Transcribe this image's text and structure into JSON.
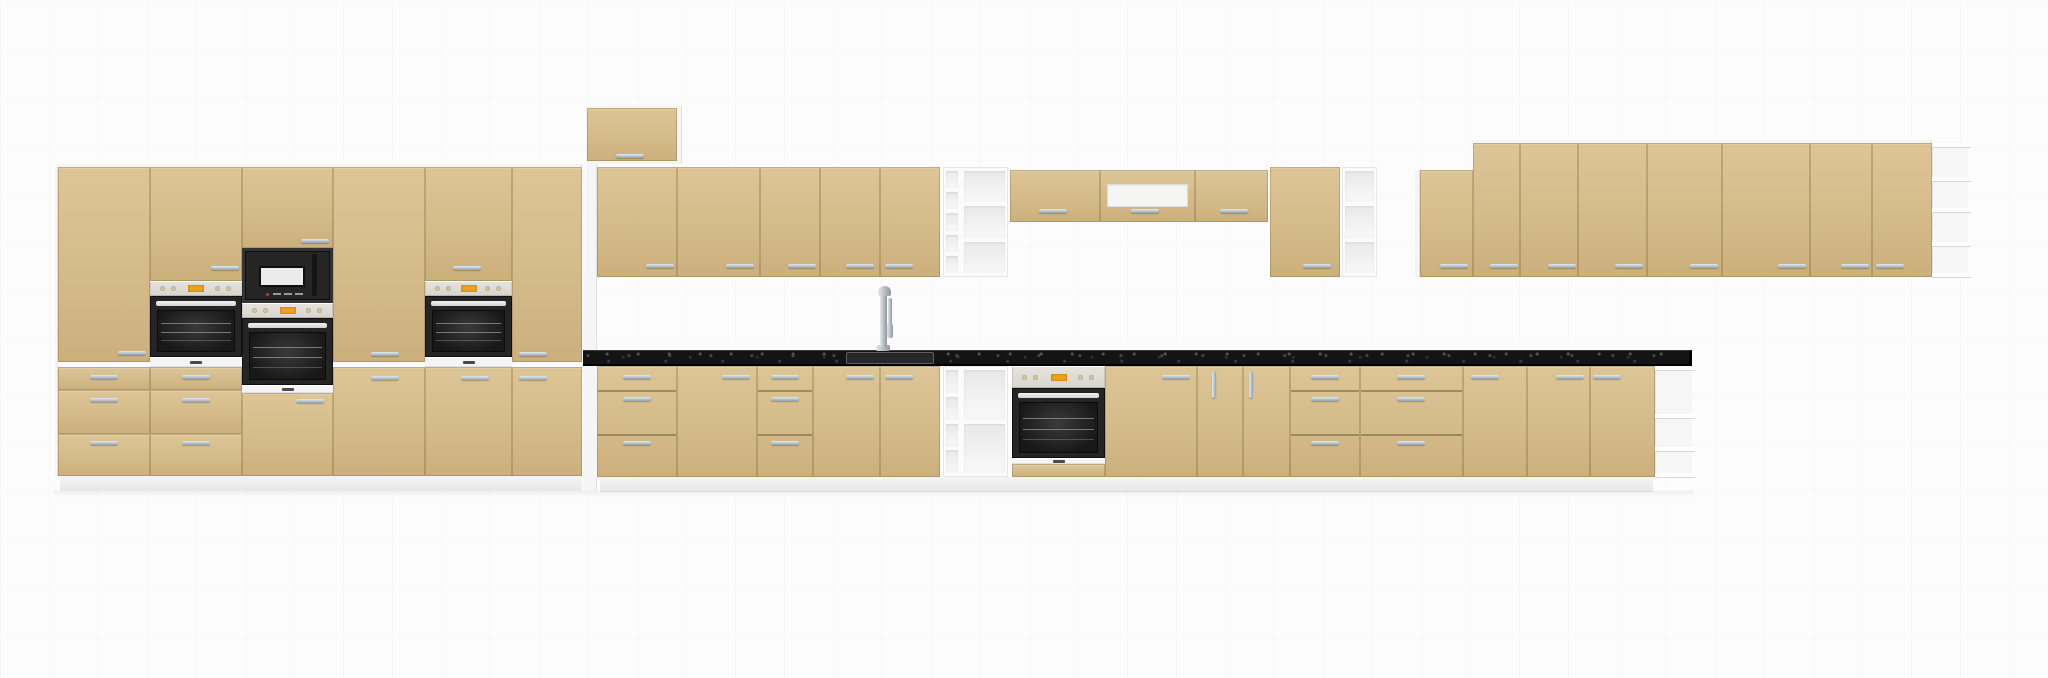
{
  "canvas": {
    "width": 2048,
    "height": 678
  },
  "palette": {
    "background": "#fcfcfc",
    "front": "#d5bb8a",
    "front_light": "#ddc596",
    "front_dark": "#cbb07c",
    "seam": "rgba(122,98,55,0.32)",
    "seam_line": "rgba(105,85,45,0.5)",
    "white": "#f5f5f5",
    "white_shadow": "#e0e0e0",
    "plinth_a": "#f4f4f4",
    "plinth_b": "#e8e8e8",
    "counter": "#141414",
    "black": "#252525",
    "black_inner": "#181818",
    "steel": "#d3d3d3",
    "panel": "#d7d5cd",
    "panel_knob": "#cfc69f",
    "amber": "#f0a21c",
    "handle_light": "#e2eaef",
    "handle_dark": "#92a5b2",
    "cell_a": "#e8e8e8",
    "cell_b": "#f6f6f6",
    "glass": "#f5f5f3",
    "chrome_light": "#e4e8ea",
    "chrome_dark": "#8e979c"
  },
  "scene": {
    "modules": [
      {
        "name": "tall-run-top-edge",
        "kind": "white",
        "x": 56,
        "y": 164,
        "w": 526,
        "h": 3
      },
      {
        "name": "tall-run-left-edge",
        "kind": "white",
        "x": 54,
        "y": 167,
        "w": 4,
        "h": 309
      },
      {
        "name": "tall-run-side-panel",
        "kind": "white",
        "x": 582,
        "y": 164,
        "w": 15,
        "h": 327
      },
      {
        "name": "tall-run-plinth",
        "kind": "plinth",
        "x": 60,
        "y": 476,
        "w": 522,
        "h": 15
      },
      {
        "name": "base-run-plinth",
        "kind": "plinth",
        "x": 600,
        "y": 477,
        "w": 1053,
        "h": 15
      },
      {
        "name": "floor-shadow",
        "kind": "shadow",
        "x": 54,
        "y": 491,
        "w": 1640,
        "h": 7
      },
      {
        "name": "tall-cabinet-1",
        "kind": "stack",
        "x": 58,
        "w": 92,
        "parts": [
          {
            "t": "door",
            "y": 167,
            "h": 195
          },
          {
            "t": "drawer",
            "y": 367,
            "h": 23
          },
          {
            "t": "drawer",
            "y": 390,
            "h": 44
          },
          {
            "t": "drawer",
            "y": 434,
            "h": 42
          }
        ],
        "handles": [
          [
            118,
            351,
            "h"
          ],
          [
            90,
            375,
            "h"
          ],
          [
            90,
            398,
            "h"
          ],
          [
            90,
            441,
            "h"
          ]
        ]
      },
      {
        "name": "oven-tower-1",
        "kind": "stack",
        "x": 150,
        "w": 92,
        "parts": [
          {
            "t": "door",
            "y": 167,
            "h": 114
          },
          {
            "t": "cpanel",
            "y": 281,
            "h": 15
          },
          {
            "t": "oven",
            "y": 296,
            "h": 61
          },
          {
            "t": "strip",
            "y": 357,
            "h": 10
          },
          {
            "t": "drawer",
            "y": 367,
            "h": 23
          },
          {
            "t": "drawer",
            "y": 390,
            "h": 44
          },
          {
            "t": "drawer",
            "y": 434,
            "h": 42
          }
        ],
        "handles": [
          [
            211,
            266,
            "h"
          ],
          [
            182,
            375,
            "h"
          ],
          [
            182,
            398,
            "h"
          ],
          [
            182,
            441,
            "h"
          ]
        ]
      },
      {
        "name": "microwave-oven-tower",
        "kind": "stack",
        "x": 242,
        "w": 91,
        "parts": [
          {
            "t": "door",
            "y": 167,
            "h": 81
          },
          {
            "t": "micro",
            "y": 248,
            "h": 55
          },
          {
            "t": "cpanel",
            "y": 303,
            "h": 15
          },
          {
            "t": "oven",
            "y": 318,
            "h": 67
          },
          {
            "t": "strip",
            "y": 385,
            "h": 8
          },
          {
            "t": "door",
            "y": 393,
            "h": 83
          }
        ],
        "handles": [
          [
            301,
            239,
            "h"
          ],
          [
            296,
            399,
            "h"
          ]
        ]
      },
      {
        "name": "tall-cabinet-2",
        "kind": "stack",
        "x": 333,
        "w": 92,
        "parts": [
          {
            "t": "door",
            "y": 167,
            "h": 195
          },
          {
            "t": "door",
            "y": 367,
            "h": 109
          }
        ],
        "handles": [
          [
            371,
            352,
            "h"
          ],
          [
            371,
            376,
            "h"
          ]
        ]
      },
      {
        "name": "oven-tower-2",
        "kind": "stack",
        "x": 425,
        "w": 87,
        "parts": [
          {
            "t": "door",
            "y": 167,
            "h": 114
          },
          {
            "t": "cpanel",
            "y": 281,
            "h": 15
          },
          {
            "t": "oven",
            "y": 296,
            "h": 61
          },
          {
            "t": "strip",
            "y": 357,
            "h": 10
          },
          {
            "t": "door",
            "y": 367,
            "h": 109
          }
        ],
        "handles": [
          [
            453,
            266,
            "h"
          ],
          [
            461,
            376,
            "h"
          ]
        ]
      },
      {
        "name": "tall-cabinet-3",
        "kind": "stack",
        "x": 512,
        "w": 70,
        "parts": [
          {
            "t": "door",
            "y": 167,
            "h": 195
          },
          {
            "t": "door",
            "y": 367,
            "h": 109
          }
        ],
        "handles": [
          [
            519,
            352,
            "h"
          ],
          [
            519,
            376,
            "h"
          ]
        ]
      },
      {
        "name": "raised-wall-cabinet",
        "kind": "raised",
        "x": 587,
        "y": 108,
        "w": 90,
        "h": 56,
        "handles": [
          [
            616,
            154,
            "h"
          ]
        ]
      },
      {
        "name": "wall-left-post",
        "kind": "white",
        "x": 585,
        "y": 164,
        "w": 12,
        "h": 113
      },
      {
        "name": "wall-cabinet-1",
        "kind": "door",
        "x": 597,
        "y": 167,
        "w": 80,
        "h": 110,
        "handles": [
          [
            646,
            264,
            "h"
          ]
        ]
      },
      {
        "name": "wall-cabinet-2",
        "kind": "door",
        "x": 677,
        "y": 167,
        "w": 83,
        "h": 110,
        "handles": [
          [
            726,
            264,
            "h"
          ]
        ]
      },
      {
        "name": "wall-cabinet-3",
        "kind": "door",
        "x": 760,
        "y": 167,
        "w": 60,
        "h": 110,
        "handles": [
          [
            788,
            264,
            "h"
          ]
        ]
      },
      {
        "name": "wall-cabinet-4",
        "kind": "door",
        "x": 820,
        "y": 167,
        "w": 60,
        "h": 110,
        "handles": [
          [
            846,
            264,
            "h"
          ]
        ]
      },
      {
        "name": "wall-cabinet-5",
        "kind": "door",
        "x": 880,
        "y": 167,
        "w": 60,
        "h": 110,
        "handles": [
          [
            885,
            264,
            "h"
          ]
        ]
      },
      {
        "name": "wall-shelf-unit",
        "kind": "shelves",
        "x": 943,
        "y": 167,
        "w": 65,
        "h": 110,
        "cols": [
          {
            "w": 18,
            "cells": 5
          },
          {
            "w": 47,
            "cells": 3
          }
        ]
      },
      {
        "name": "short-wall-cabinet-1",
        "kind": "door",
        "x": 1010,
        "y": 170,
        "w": 90,
        "h": 52,
        "handles": [
          [
            1039,
            209,
            "h"
          ]
        ]
      },
      {
        "name": "hood-cabinet",
        "kind": "hood",
        "x": 1100,
        "y": 170,
        "w": 95,
        "h": 52,
        "glass": {
          "dx": 7,
          "dy": 14,
          "h": 23
        },
        "handles": [
          [
            1131,
            209,
            "h"
          ]
        ]
      },
      {
        "name": "short-wall-cabinet-2",
        "kind": "door",
        "x": 1195,
        "y": 170,
        "w": 73,
        "h": 52,
        "handles": [
          [
            1220,
            209,
            "h"
          ]
        ]
      },
      {
        "name": "wall-cabinet-6",
        "kind": "door",
        "x": 1270,
        "y": 167,
        "w": 70,
        "h": 110,
        "handles": [
          [
            1303,
            264,
            "h"
          ]
        ]
      },
      {
        "name": "wall-open-shelf",
        "kind": "shelves",
        "x": 1342,
        "y": 167,
        "w": 35,
        "h": 110,
        "cols": [
          {
            "w": 35,
            "cells": 3
          }
        ]
      },
      {
        "name": "right-run-top-edge",
        "kind": "white",
        "x": 1473,
        "y": 140,
        "w": 459,
        "h": 3
      },
      {
        "name": "right-wall-post",
        "kind": "white",
        "x": 1414,
        "y": 170,
        "w": 6,
        "h": 107
      },
      {
        "name": "right-wall-cabinet-1",
        "kind": "door",
        "x": 1420,
        "y": 170,
        "w": 53,
        "h": 107,
        "handles": [
          [
            1440,
            264,
            "h"
          ]
        ]
      },
      {
        "name": "right-wall-cabinet-2",
        "kind": "door",
        "x": 1473,
        "y": 143,
        "w": 47,
        "h": 134,
        "handles": [
          [
            1490,
            264,
            "h"
          ]
        ]
      },
      {
        "name": "right-wall-cabinet-3",
        "kind": "door",
        "x": 1520,
        "y": 143,
        "w": 58,
        "h": 134,
        "handles": [
          [
            1548,
            264,
            "h"
          ]
        ]
      },
      {
        "name": "right-wall-cabinet-4",
        "kind": "door",
        "x": 1578,
        "y": 143,
        "w": 69,
        "h": 134,
        "handles": [
          [
            1615,
            264,
            "h"
          ]
        ]
      },
      {
        "name": "right-wall-cabinet-5",
        "kind": "door",
        "x": 1647,
        "y": 143,
        "w": 75,
        "h": 134,
        "handles": [
          [
            1690,
            264,
            "h"
          ]
        ]
      },
      {
        "name": "right-wall-cabinet-6",
        "kind": "door",
        "x": 1722,
        "y": 143,
        "w": 88,
        "h": 134,
        "handles": [
          [
            1778,
            264,
            "h"
          ]
        ]
      },
      {
        "name": "right-wall-cabinet-7",
        "kind": "door",
        "x": 1810,
        "y": 143,
        "w": 62,
        "h": 134,
        "handles": [
          [
            1841,
            264,
            "h"
          ]
        ]
      },
      {
        "name": "right-wall-cabinet-8",
        "kind": "door",
        "x": 1872,
        "y": 143,
        "w": 60,
        "h": 134,
        "handles": [
          [
            1876,
            264,
            "h"
          ]
        ]
      },
      {
        "name": "right-corner-shelf",
        "kind": "corner-shelf",
        "x": 1932,
        "y": 143,
        "w": 36,
        "h": 134,
        "fins": [
          177,
          208,
          242
        ]
      },
      {
        "name": "base-filler",
        "kind": "white",
        "x": 582,
        "y": 366,
        "w": 16,
        "h": 111
      },
      {
        "name": "base-drawer-unit-1",
        "kind": "drawers",
        "x": 597,
        "y": 366,
        "w": 80,
        "h": 111,
        "rows": [
          24,
          44,
          43
        ],
        "handles": [
          [
            623,
            375,
            "h"
          ],
          [
            623,
            397,
            "h"
          ],
          [
            623,
            441,
            "h"
          ]
        ]
      },
      {
        "name": "base-cabinet-1",
        "kind": "door",
        "x": 677,
        "y": 366,
        "w": 80,
        "h": 111,
        "handles": [
          [
            722,
            375,
            "h"
          ]
        ]
      },
      {
        "name": "base-drawer-unit-2",
        "kind": "drawers",
        "x": 757,
        "y": 366,
        "w": 56,
        "h": 111,
        "rows": [
          24,
          44,
          43
        ],
        "handles": [
          [
            771,
            375,
            "h"
          ],
          [
            771,
            397,
            "h"
          ],
          [
            771,
            441,
            "h"
          ]
        ]
      },
      {
        "name": "sink-base-cabinet-left",
        "kind": "door",
        "x": 813,
        "y": 366,
        "w": 67,
        "h": 111,
        "handles": [
          [
            846,
            375,
            "h"
          ]
        ]
      },
      {
        "name": "sink-base-cabinet-right",
        "kind": "door",
        "x": 880,
        "y": 366,
        "w": 60,
        "h": 111,
        "handles": [
          [
            885,
            375,
            "h"
          ]
        ]
      },
      {
        "name": "base-shelf-unit",
        "kind": "shelves",
        "x": 943,
        "y": 366,
        "w": 65,
        "h": 111,
        "cols": [
          {
            "w": 18,
            "cells": 4
          },
          {
            "w": 47,
            "cells": 2
          }
        ]
      },
      {
        "name": "built-in-oven-base",
        "kind": "base-oven",
        "x": 1012,
        "y": 366,
        "w": 93,
        "h": 111
      },
      {
        "name": "base-cabinet-2",
        "kind": "door",
        "x": 1105,
        "y": 366,
        "w": 92,
        "h": 111,
        "handles": [
          [
            1162,
            375,
            "h"
          ]
        ]
      },
      {
        "name": "base-cabinet-3",
        "kind": "door",
        "x": 1197,
        "y": 366,
        "w": 46,
        "h": 111,
        "handles": [
          [
            1212,
            371,
            "v"
          ]
        ]
      },
      {
        "name": "base-cabinet-4",
        "kind": "door",
        "x": 1243,
        "y": 366,
        "w": 47,
        "h": 111,
        "handles": [
          [
            1249,
            371,
            "v"
          ]
        ]
      },
      {
        "name": "base-drawer-unit-3",
        "kind": "drawers",
        "x": 1290,
        "y": 366,
        "w": 70,
        "h": 111,
        "rows": [
          24,
          44,
          43
        ],
        "handles": [
          [
            1311,
            375,
            "h"
          ],
          [
            1311,
            397,
            "h"
          ],
          [
            1311,
            441,
            "h"
          ]
        ]
      },
      {
        "name": "base-drawer-unit-4",
        "kind": "drawers",
        "x": 1360,
        "y": 366,
        "w": 103,
        "h": 111,
        "rows": [
          24,
          44,
          43
        ],
        "handles": [
          [
            1397,
            375,
            "h"
          ],
          [
            1397,
            397,
            "h"
          ],
          [
            1397,
            441,
            "h"
          ]
        ]
      },
      {
        "name": "base-cabinet-5",
        "kind": "door",
        "x": 1463,
        "y": 366,
        "w": 64,
        "h": 111,
        "handles": [
          [
            1471,
            375,
            "h"
          ]
        ]
      },
      {
        "name": "base-cabinet-6",
        "kind": "door",
        "x": 1527,
        "y": 366,
        "w": 63,
        "h": 111,
        "handles": [
          [
            1556,
            375,
            "h"
          ]
        ]
      },
      {
        "name": "base-cabinet-7",
        "kind": "door",
        "x": 1590,
        "y": 366,
        "w": 65,
        "h": 111,
        "handles": [
          [
            1593,
            375,
            "h"
          ]
        ]
      },
      {
        "name": "base-end-shelf",
        "kind": "corner-shelf",
        "x": 1655,
        "y": 366,
        "w": 37,
        "h": 111,
        "fins": [
          414,
          447
        ]
      },
      {
        "name": "countertop",
        "kind": "counter",
        "x": 583,
        "y": 350,
        "w": 1109,
        "h": 16,
        "sink": {
          "x": 846,
          "y": 352,
          "w": 88,
          "h": 12
        }
      },
      {
        "name": "kitchen-faucet",
        "kind": "faucet",
        "x": 870,
        "y": 286,
        "w": 26,
        "h": 66
      }
    ]
  }
}
